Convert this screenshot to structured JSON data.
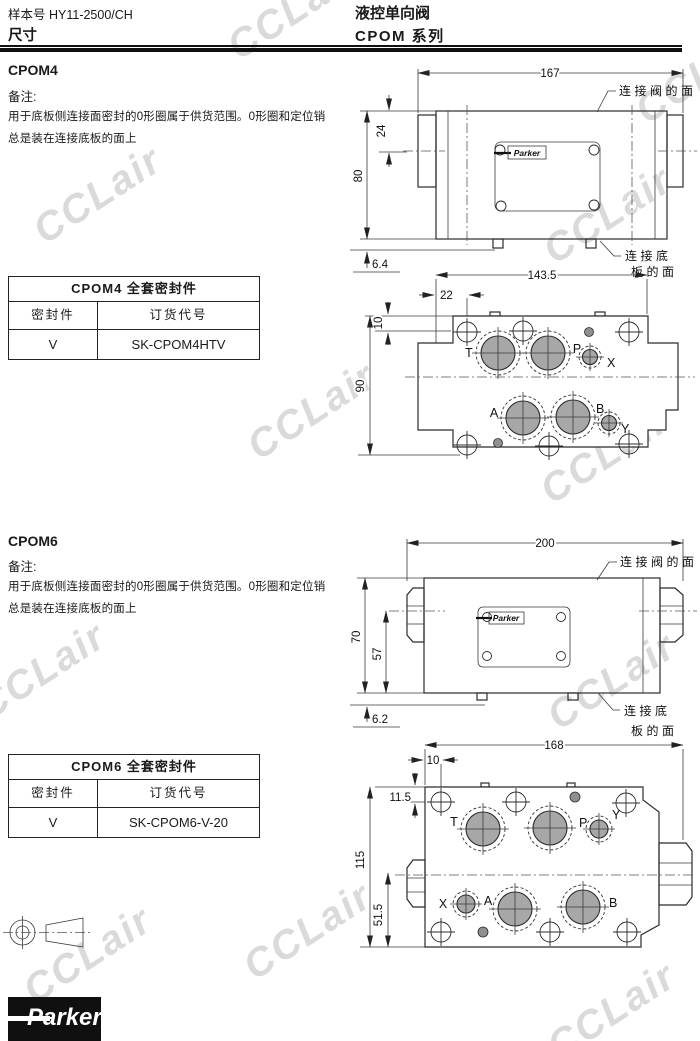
{
  "watermark": {
    "text": "CCLair"
  },
  "header": {
    "doc_number": "样本号 HY11-2500/CH",
    "page_title": "尺寸",
    "product_title": "液控单向阀",
    "series_title": "CPOM 系列"
  },
  "cpom4": {
    "heading": "CPOM4",
    "notes": {
      "label": "备注:",
      "line1": "用于底板侧连接面密封的0形圈属于供货范围。0形圈和定位销",
      "line2": "总是装在连接底板的面上"
    },
    "seal_table": {
      "title": "CPOM4 全套密封件",
      "col_seal": "密封件",
      "col_code": "订货代号",
      "seal": "V",
      "code": "SK-CPOM4HTV"
    },
    "side_view": {
      "nameplate_brand": "Parker",
      "label_valve_face": "连接阀的面",
      "label_subplate_face_line1": "连接底",
      "label_subplate_face_line2": "板的面",
      "dims": {
        "width": "167",
        "top_offset": "24",
        "height": "80",
        "pin": "6.4"
      }
    },
    "top_view": {
      "dims": {
        "width": "143.5",
        "port_offset_x": "22",
        "port_offset_y": "10",
        "height": "90"
      },
      "ports": {
        "t": "T",
        "p": "P",
        "x": "X",
        "a": "A",
        "b": "B",
        "y": "Y"
      }
    }
  },
  "cpom6": {
    "heading": "CPOM6",
    "notes": {
      "label": "备注:",
      "line1": "用于底板侧连接面密封的0形圈属于供货范围。0形圈和定位销",
      "line2": "总是装在连接底板的面上"
    },
    "seal_table": {
      "title": "CPOM6 全套密封件",
      "col_seal": "密封件",
      "col_code": "订货代号",
      "seal": "V",
      "code": "SK-CPOM6-V-20"
    },
    "side_view": {
      "nameplate_brand": "Parker",
      "label_valve_face": "连接阀的面",
      "label_subplate_face_line1": "连接底",
      "label_subplate_face_line2": "板的面",
      "dims": {
        "width": "200",
        "height": "70",
        "center_height": "57",
        "pin": "6.2"
      }
    },
    "top_view": {
      "dims": {
        "width": "168",
        "port_offset_x": "10",
        "port_offset_y": "11.5",
        "height": "115",
        "center_offset": "51.5"
      },
      "ports": {
        "t": "T",
        "p": "P",
        "y": "Y",
        "x": "X",
        "a": "A",
        "b": "B"
      }
    }
  },
  "footer": {
    "brand": "Parker"
  }
}
